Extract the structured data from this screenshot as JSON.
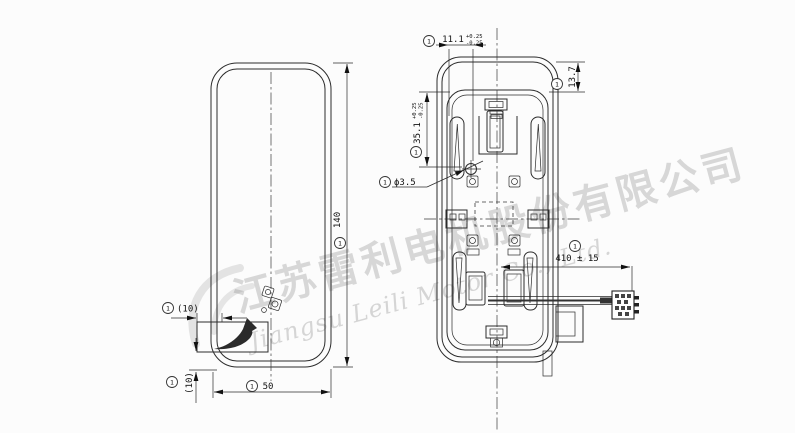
{
  "watermark": {
    "company_cn": "江苏雷利电机股份有限公司",
    "company_en": "Jiangsu Leili Motor Co., Ltd."
  },
  "dims": {
    "d140": {
      "balloon": "1",
      "text": "140"
    },
    "d50": {
      "balloon": "1",
      "text": "50"
    },
    "d10h": {
      "balloon": "1",
      "text": "(10)"
    },
    "d10v": {
      "balloon": "1",
      "text": "(10)"
    },
    "d111": {
      "balloon": "1",
      "text": "11.1",
      "tp": "+0.25",
      "tm": "-0.25"
    },
    "d137": {
      "balloon": "1",
      "text": "13.7"
    },
    "d351": {
      "balloon": "1",
      "text": "35.1",
      "tp": "+0.25",
      "tm": "-0.25"
    },
    "dphi": {
      "balloon": "1",
      "text": "ϕ3.5"
    },
    "d410": {
      "balloon": "1",
      "text": "410 ± 15"
    }
  },
  "colors": {
    "line": "#2b2b2b",
    "watermark": "#999999",
    "background": "#fcfcfc"
  }
}
